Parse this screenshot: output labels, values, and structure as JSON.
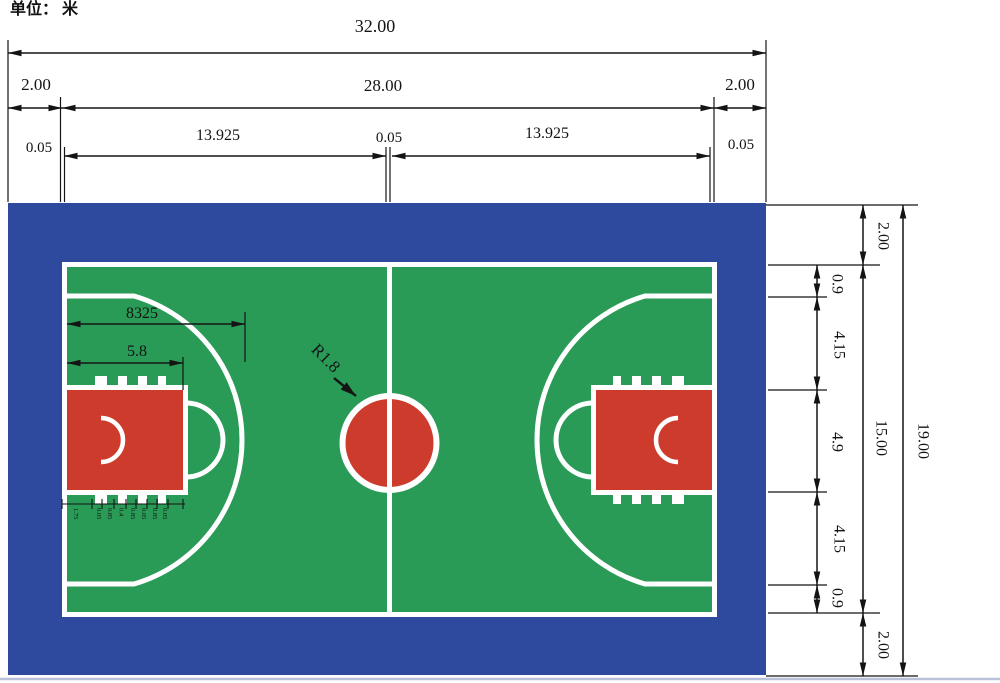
{
  "unit_label": "单位： 米",
  "colors": {
    "buffer_blue": "#2E4A9E",
    "court_green": "#2A9A57",
    "paint_red": "#CC3B2B",
    "line_white": "#FFFFFF",
    "dim_black": "#141414"
  },
  "dims": {
    "top": {
      "overall": "32.00",
      "buffer_left": "2.00",
      "court_width": "28.00",
      "buffer_right": "2.00",
      "line_left": "0.05",
      "half_left": "13.925",
      "center_line": "0.05",
      "half_right": "13.925",
      "line_right": "0.05"
    },
    "right": {
      "buffer_top": "2.00",
      "gap_top": "0.9",
      "wing_top": "4.15",
      "key_width": "4.9",
      "wing_bottom": "4.15",
      "gap_bottom": "0.9",
      "buffer_bottom": "2.00",
      "court_height": "15.00",
      "overall": "19.00"
    },
    "inner": {
      "arc_reach": "8325",
      "key_length": "5.8",
      "center_radius": "R1.8"
    },
    "lane": [
      "1.75",
      "0.05",
      "0.85",
      "0.4",
      "0.85",
      "0.05",
      "0.85",
      "0.05"
    ]
  }
}
